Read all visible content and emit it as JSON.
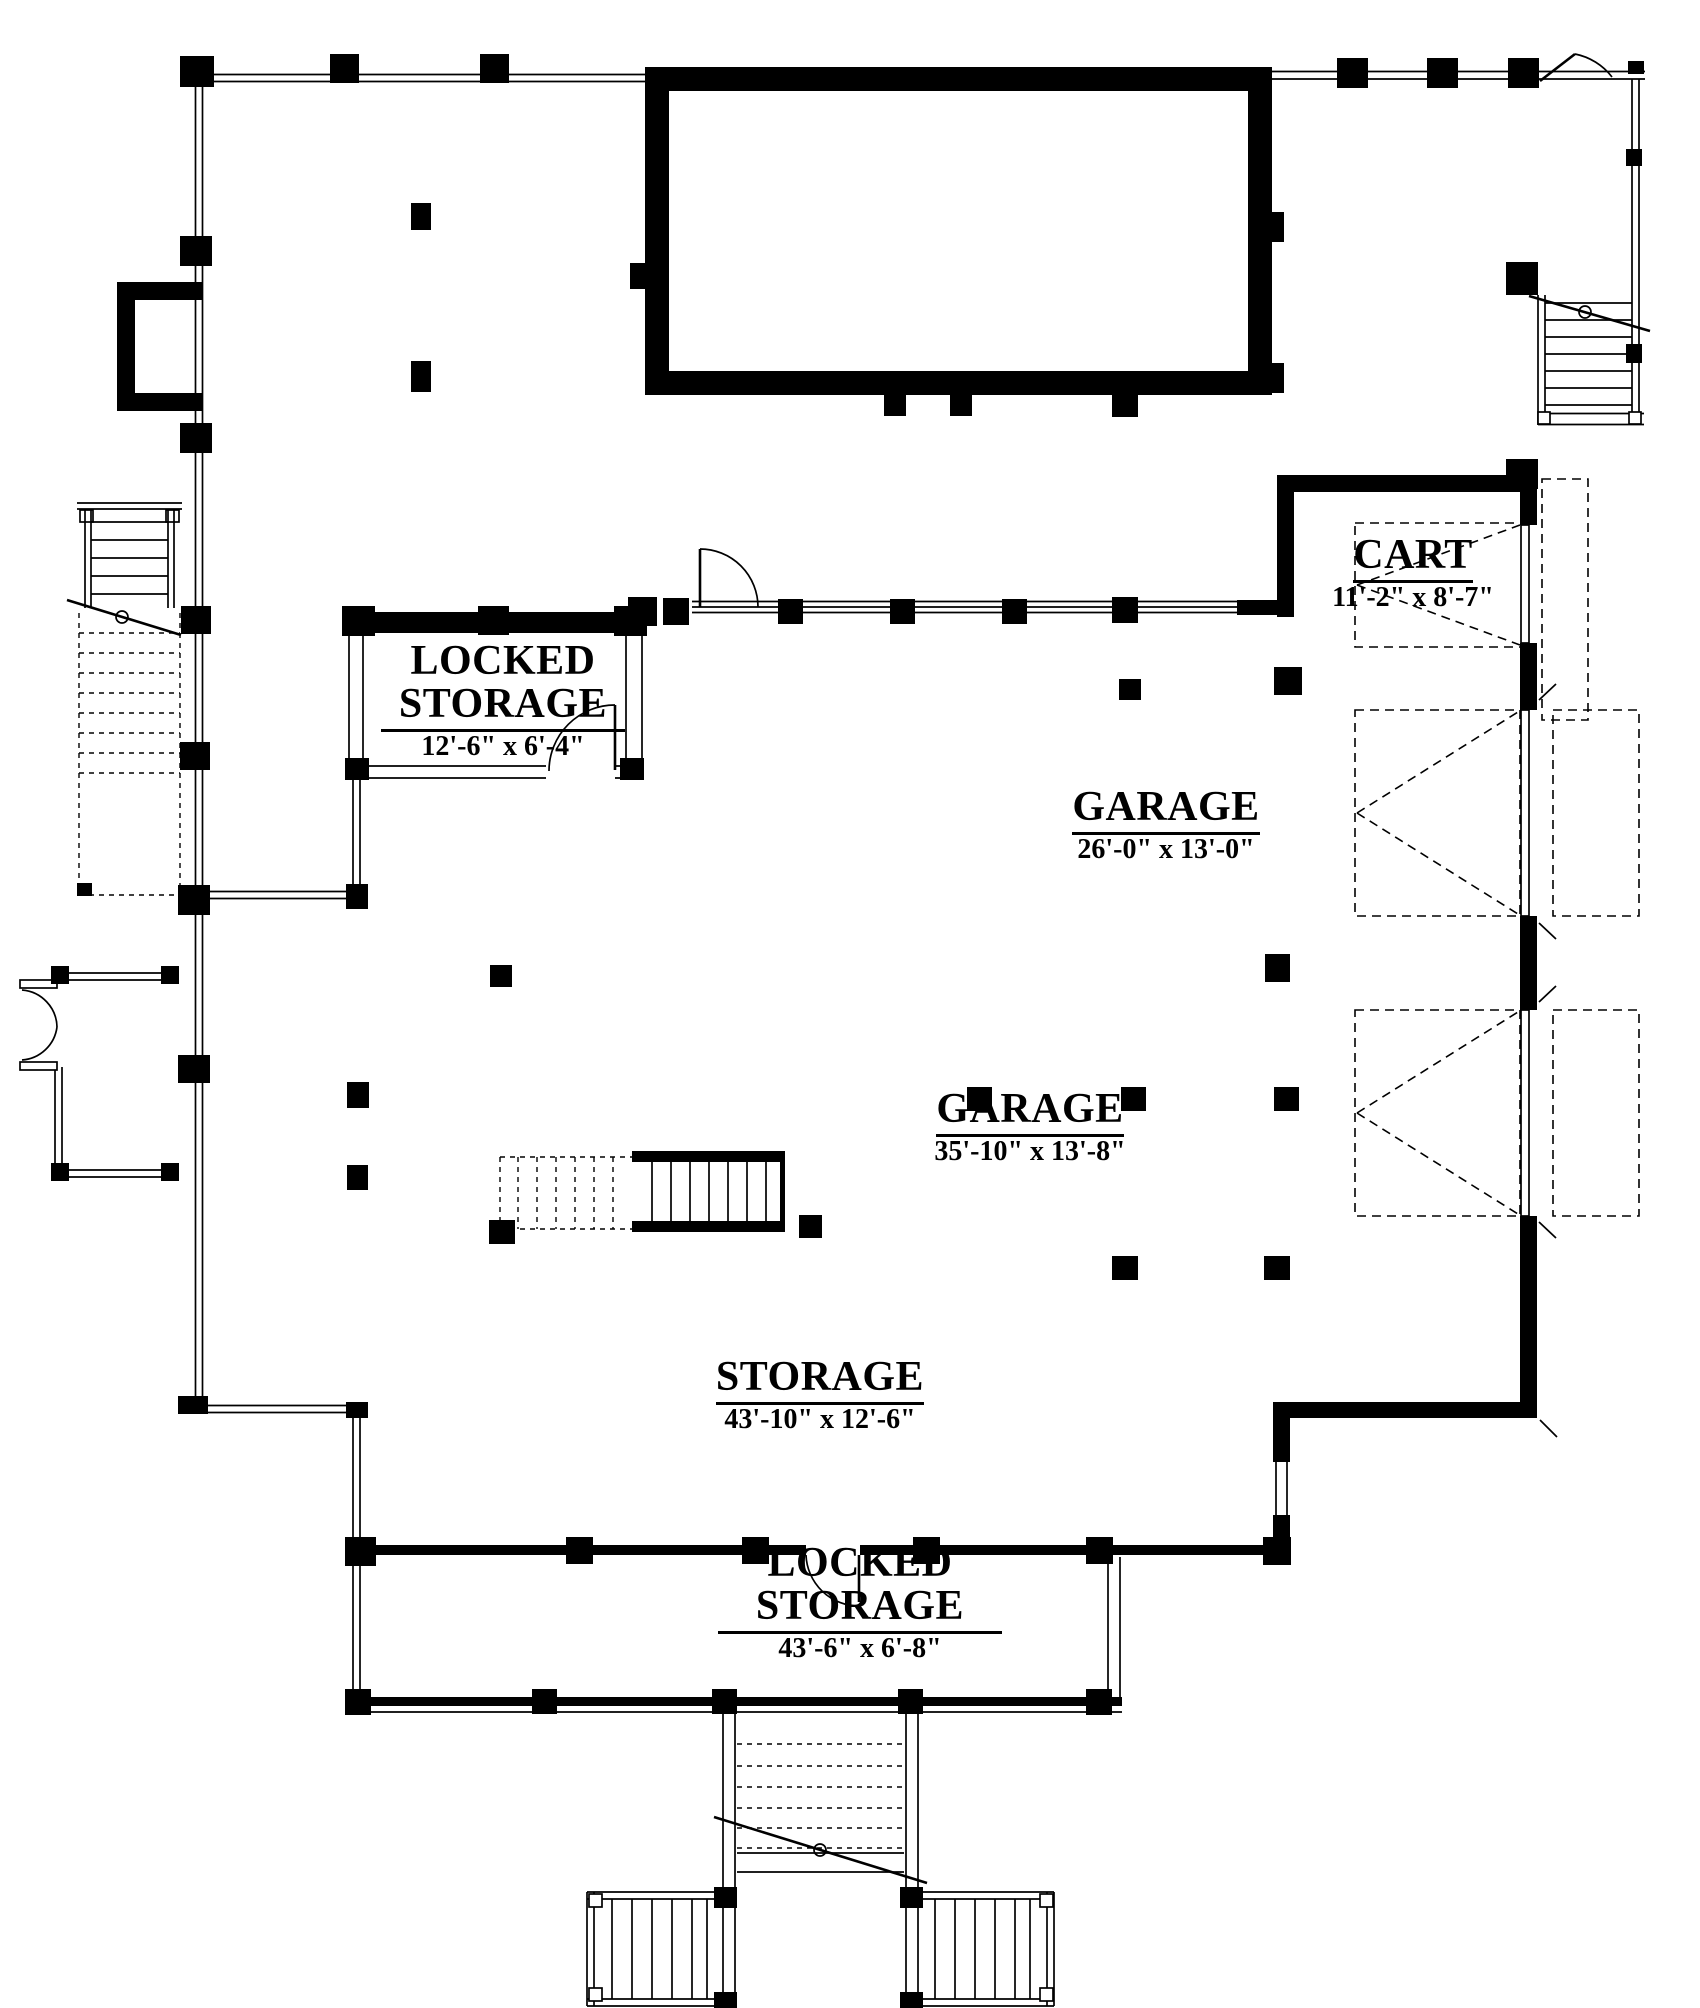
{
  "plan": {
    "rooms": [
      {
        "name": "LOCKED STORAGE",
        "dims": "12'-6\" x 6'-4\""
      },
      {
        "name": "GARAGE",
        "dims": "26'-0\" x 13'-0\""
      },
      {
        "name": "CART",
        "dims": "11'-2\" x 8'-7\""
      },
      {
        "name": "GARAGE",
        "dims": "35'-10\" x 13'-8\""
      },
      {
        "name": "STORAGE",
        "dims": "43'-10\" x 12'-6\""
      },
      {
        "name": "LOCKED STORAGE",
        "dims": "43'-6\" x 6'-8\""
      }
    ],
    "colors": {
      "ink": "#000000",
      "paper": "#ffffff"
    }
  }
}
